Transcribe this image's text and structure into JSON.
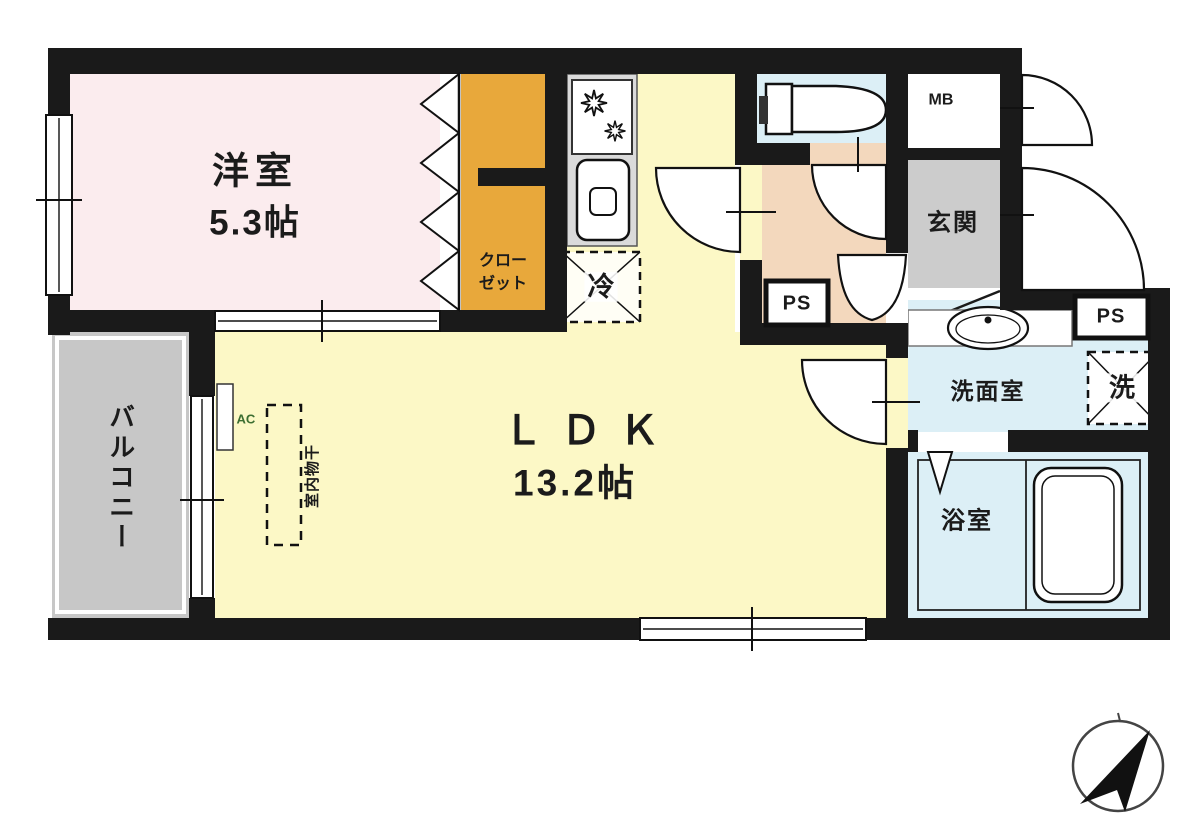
{
  "plan_title": "1LDK floor plan",
  "rooms": {
    "western_room": {
      "label": "洋室",
      "size": "5.3帖"
    },
    "closet": {
      "lines": [
        "クロー",
        "ゼット"
      ],
      "full": "クローゼット"
    },
    "ldk": {
      "label": "ＬＤＫ",
      "size": "13.2帖"
    },
    "balcony": {
      "label": "バルコニー"
    },
    "entrance": {
      "label": "玄関"
    },
    "washroom": {
      "label": "洗面室"
    },
    "bathroom": {
      "label": "浴室"
    }
  },
  "fixtures": {
    "refrigerator": "冷",
    "washer": "洗",
    "pipe_space_hall": "PS",
    "pipe_space_right": "PS",
    "meter_box": "MB",
    "air_conditioner": "AC",
    "indoor_drying": "室内物干"
  },
  "icons": {
    "compass": "compass-arrow-northeast",
    "stove": "gas-stove-two-burners",
    "sink": "kitchen-sink",
    "toilet": "toilet",
    "basin": "wash-basin",
    "bathtub": "bathtub"
  },
  "colors": {
    "wall": "#1a1a1a",
    "western_room_fill": "#fbecee",
    "ldk_fill": "#fcf8c6",
    "closet_fill": "#e8a83b",
    "hall_fill": "#f3d8bd",
    "wet_room_fill": "#dceff6",
    "balcony_fill": "#c7c7c7",
    "entrance_fill": "#cccccc",
    "counter_fill": "#dadada",
    "ac_text": "#3c6e31"
  }
}
